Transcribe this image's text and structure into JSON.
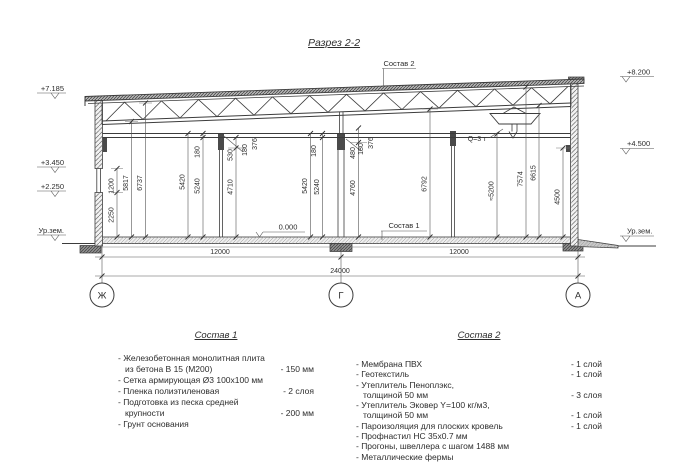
{
  "title": "Разрез 2-2",
  "refs": {
    "sostav1": "Состав 1",
    "sostav2": "Состав 2"
  },
  "marks": {
    "zero": "0.000",
    "crane": "Q=3 т",
    "ground": "Ур.зем."
  },
  "elevations": {
    "left": [
      "+7.185",
      "+3.450",
      "+2.250"
    ],
    "right": [
      "+8.200",
      "+4.500"
    ]
  },
  "axes": [
    "Ж",
    "Г",
    "А"
  ],
  "dims": {
    "vertical": [
      "1200",
      "2250",
      "5817",
      "6737",
      "5420",
      "5240",
      "180",
      "530",
      "4710",
      "180",
      "376",
      "5420",
      "5240",
      "180",
      "480",
      "180",
      "376",
      "4760",
      "6792",
      "≈5200",
      "7574",
      "6615",
      "4500"
    ],
    "horizontal": [
      "12000",
      "12000",
      "24000"
    ]
  },
  "sostav1": {
    "title": "Состав 1",
    "items": [
      {
        "text": "- Железобетонная  монолитная плита",
        "value": ""
      },
      {
        "text": "из бетона В 15 (М200)",
        "value": "- 150 мм",
        "indent": true
      },
      {
        "text": "- Сетка армирующая Ø3 100х100 мм",
        "value": ""
      },
      {
        "text": "- Пленка полиэтиленовая",
        "value": "- 2 слоя"
      },
      {
        "text": "- Подготовка из песка средней",
        "value": ""
      },
      {
        "text": "крупности",
        "value": "- 200 мм",
        "indent": true
      },
      {
        "text": "- Грунт основания",
        "value": ""
      }
    ]
  },
  "sostav2": {
    "title": "Состав 2",
    "items": [
      {
        "text": "- Мембрана ПВХ",
        "value": "- 1 слой"
      },
      {
        "text": "- Геотекстиль",
        "value": "- 1 слой"
      },
      {
        "text": "- Утеплитель Пеноплэкс,",
        "value": ""
      },
      {
        "text": "толщиной 50 мм",
        "value": "- 3 слоя",
        "indent": true
      },
      {
        "text": "- Утеплитель Эковер Y=100 кг/м3,",
        "value": ""
      },
      {
        "text": "толщиной 50 мм",
        "value": "- 1 слой",
        "indent": true
      },
      {
        "text": "- Пароизоляция для плоских кровель",
        "value": "- 1 слой"
      },
      {
        "text": "- Профнастил НС 35х0.7 мм",
        "value": ""
      },
      {
        "text": "- Прогоны, швеллера с шагом 1488 мм",
        "value": ""
      },
      {
        "text": "- Металлические фермы",
        "value": ""
      }
    ]
  }
}
